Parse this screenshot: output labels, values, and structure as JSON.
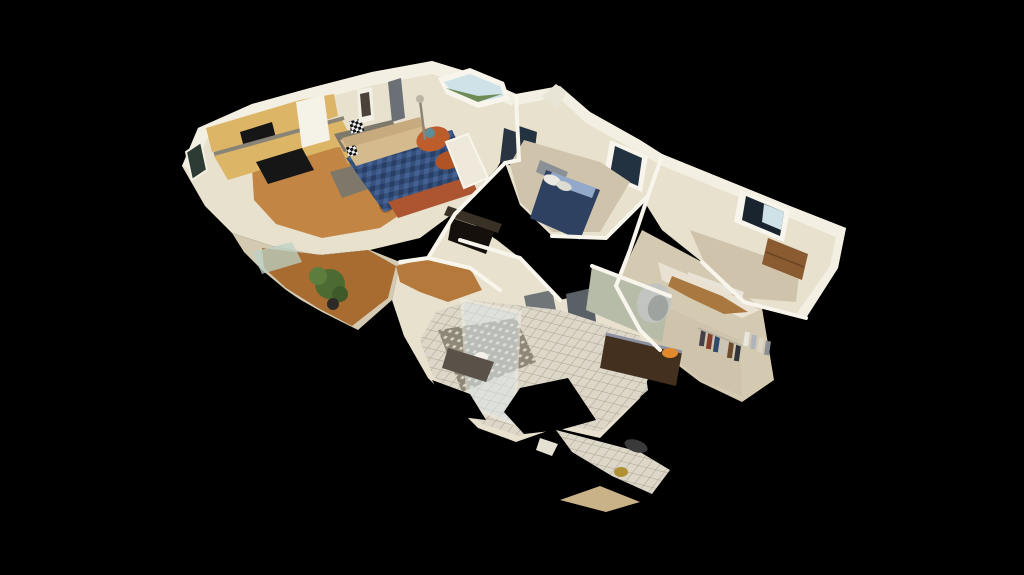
{
  "scene": {
    "title": "3D dollhouse cutaway view of single-storey home interior",
    "view_style": "isometric dollhouse (photogrammetry scan, ragged cut edges)",
    "background": "#000000",
    "rooms": [
      {
        "id": "kitchen",
        "label": "Kitchen"
      },
      {
        "id": "living-room",
        "label": "Living Room"
      },
      {
        "id": "dining-entry",
        "label": "Dining / Entry"
      },
      {
        "id": "hallway-stairs",
        "label": "Hallway / Stairwell"
      },
      {
        "id": "bedroom-1",
        "label": "Bedroom 1"
      },
      {
        "id": "bedroom-2",
        "label": "Bedroom 2"
      },
      {
        "id": "walk-in-closet",
        "label": "Walk-in Closet"
      },
      {
        "id": "ensuite-bath",
        "label": "Ensuite Bathroom"
      }
    ],
    "palette": {
      "background": "#000000",
      "ceilingBand": "#f3efe2",
      "wall": "#e8e1ce",
      "wallShaded": "#d4cab2",
      "wallSage": "#b7bca9",
      "woodFloor": "#c28544",
      "woodFloorEntry": "#a86c31",
      "woodFloorHall": "#b5793c",
      "cabinet": "#dcb567",
      "pantryDoor": "#f5f2e8",
      "counterGranite": "#7d786a",
      "applianceBlack": "#161616",
      "sofa": "#d5ba8e",
      "chaiseOrange": "#bc5d2b",
      "pillowTeal": "#5d8e97",
      "rugBlue": "#34507b",
      "hearthTerracotta": "#ad5430",
      "bedBlanket": "#2f4161",
      "bedSheet": "#93a9c9",
      "pillowWhite": "#ece9e2",
      "headboard": "#8b8f96",
      "carpetBeige": "#cfc4ab",
      "tile": "#dcd7c8",
      "tilePattern": "#8e8878",
      "vanityWood": "#43301f",
      "mirrorSilver": "#c2c4c1",
      "bowlOrange": "#e2892b",
      "plantGreen": "#4c6b33",
      "doorGray": "#596066",
      "applianceGray": "#707578",
      "windowDark": "#223240",
      "windowSky": "#cfe2e8",
      "viewGreen": "#6e8a55",
      "dresserWood": "#8a5a30",
      "benchWood": "#7a5a38",
      "fragmentGold": "#b19135",
      "white": "#f8f5ec",
      "matDark": "#5a5148",
      "banister": "#3a3126",
      "stairVoid": "#15100b"
    }
  }
}
